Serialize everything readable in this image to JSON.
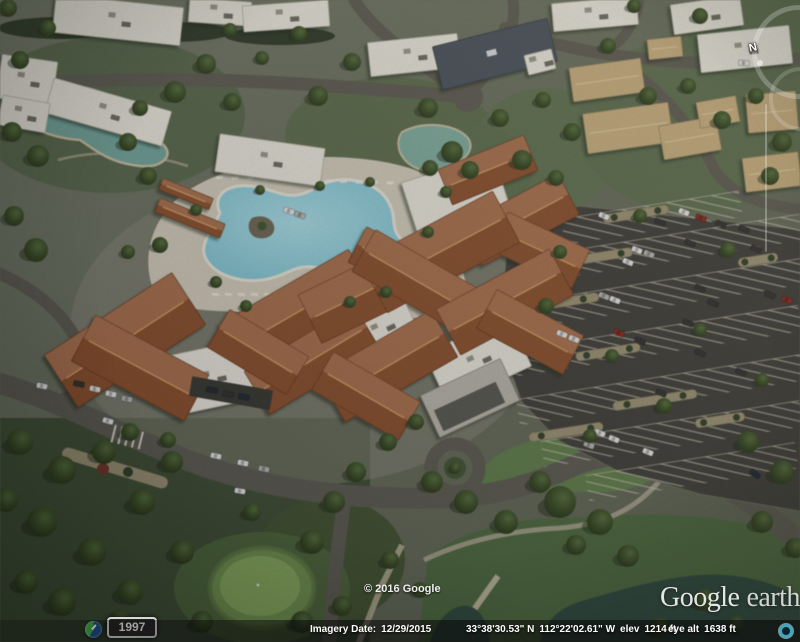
{
  "app": {
    "name": "Google Earth viewport"
  },
  "status_bar": {
    "imagery_date_label": "Imagery Date:",
    "imagery_date": "12/29/2015",
    "latitude": "33°38'30.53\" N",
    "longitude": "112°22'02.61\" W",
    "elevation_label": "elev",
    "elevation": "1214 ft",
    "eye_altitude_label": "eye alt",
    "eye_altitude": "1638 ft"
  },
  "time_badge": {
    "year": "1997"
  },
  "attribution": {
    "copyright": "© 2016 Google"
  },
  "watermark": {
    "brand": "Google",
    "product": "earth"
  },
  "navigation": {
    "north_label": "N"
  },
  "colors": {
    "pool_water": "#85cbd9",
    "terracotta_roof": "#9c5a33",
    "asphalt": "#3c3b37",
    "badge_border": "#d8d8d8",
    "streaming_ring": "#3fa7bd",
    "pond_water": "#2b463c"
  }
}
